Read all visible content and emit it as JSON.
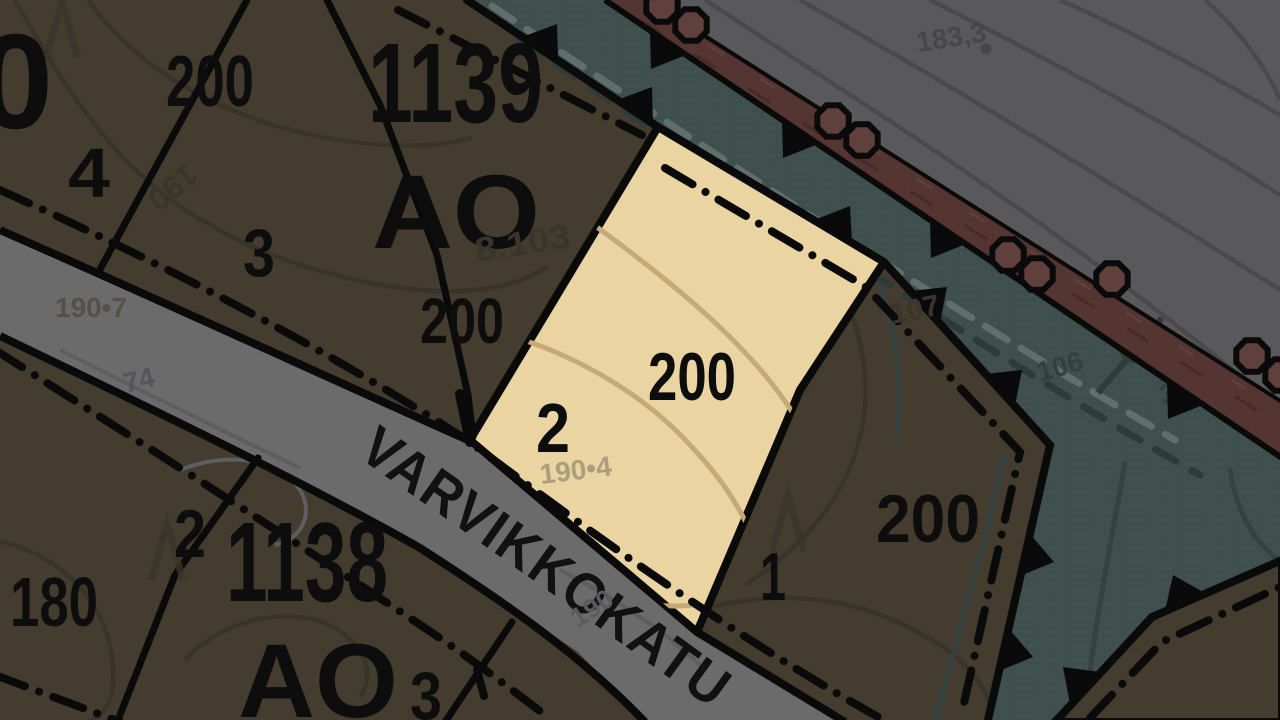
{
  "map": {
    "street": {
      "name": "VARVIKKOKATU"
    },
    "blocks": {
      "block_1139": "1139",
      "block_1138": "1138",
      "zone_block1139": "AO",
      "zone_block1138": "AO"
    },
    "labels": {
      "partial_zero": "0",
      "area_200_nw": "200",
      "plot_4": "4",
      "plot_3_block1139": "3",
      "area_200_block1139": "200",
      "parcel_ref_8103": "8.103",
      "parcel_ref_107": "107",
      "contour_190_nw": "190",
      "contour_190_road": "190",
      "elevation_190_7": "190•7",
      "elevation_190_4": "190•4",
      "elevation_183_3": "183,3",
      "elevation_74": "74",
      "ref_106": "106",
      "ref_36": "36",
      "plot_2_highlight": "2",
      "area_200_highlight": "200",
      "plot_1_east": "1",
      "area_200_east": "200",
      "plot_2_block1138": "2",
      "plot_3_block1138": "3",
      "area_180": "180"
    },
    "colors": {
      "parcel_olive": "#443c2e",
      "parcel_highlight": "#ead5a2",
      "road_gray": "#6b6b6b",
      "zone_gray": "#59595c",
      "green_teal": "#3f4f4d",
      "corridor_maroon": "#543532",
      "boundary_black": "#0a0a0a",
      "contour_tan": "#c5a977"
    }
  }
}
